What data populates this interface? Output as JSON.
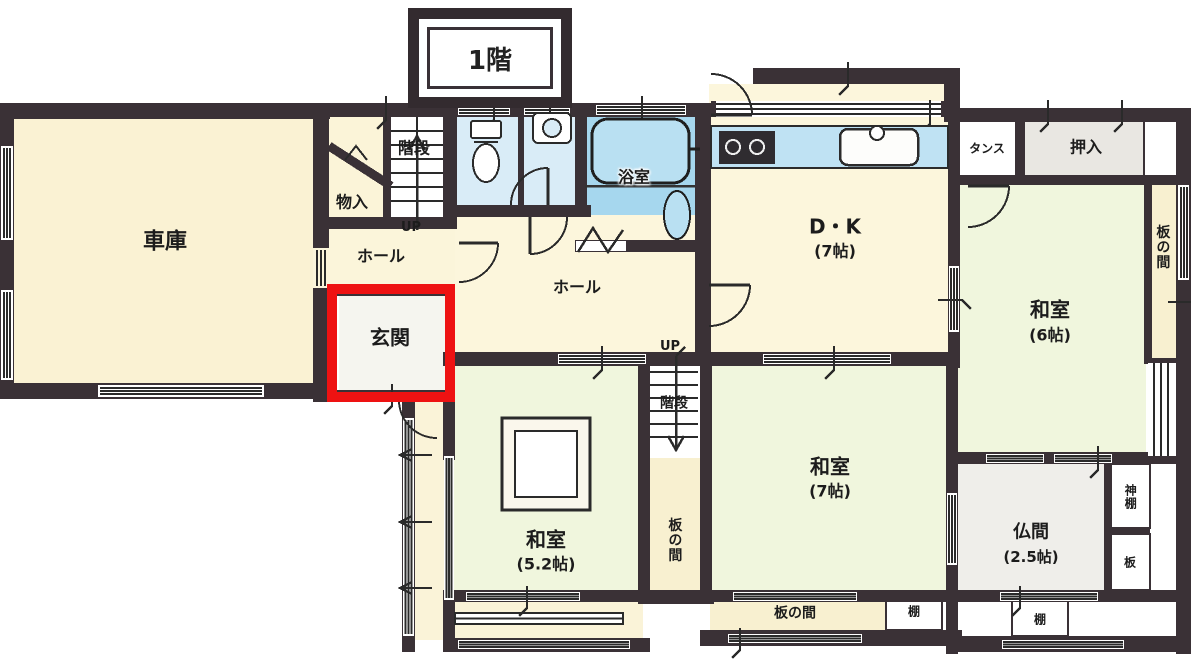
{
  "floor_title": "1階",
  "colors": {
    "wall": "#3a3136",
    "highlight_red": "#ee1212",
    "bath_blue": "#a6d7ee",
    "fixture_blue": "#d9ecf7",
    "counter_blue": "#bfe2f3",
    "tatami_green": "#f0f6dd",
    "cream": "#fbf4d8",
    "itanoma_tan": "#f8f0d0",
    "closet_gray": "#e9e7e2"
  },
  "rooms": {
    "garage": {
      "label": "車庫"
    },
    "storage": {
      "label": "物入"
    },
    "stairs_upper": {
      "label": "階段",
      "direction": "UP"
    },
    "hall_upper": {
      "label": "ホール"
    },
    "entrance": {
      "label": "玄関"
    },
    "bathroom": {
      "label": "浴室"
    },
    "hall_main": {
      "label": "ホール"
    },
    "dining_kitchen": {
      "label": "D・K",
      "size": "(7帖)"
    },
    "tansu": {
      "label": "タンス"
    },
    "oshiire": {
      "label": "押入"
    },
    "washitsu_6": {
      "label": "和室",
      "size": "(6帖)"
    },
    "itanoma_right": {
      "label": "板の間"
    },
    "washitsu_7": {
      "label": "和室",
      "size": "(7帖)"
    },
    "stairs_lower": {
      "label": "階段",
      "direction": "UP"
    },
    "itanoma_center": {
      "label": "板の間"
    },
    "washitsu_5_2": {
      "label": "和室",
      "size": "(5.2帖)"
    },
    "butsuma": {
      "label": "仏間",
      "size": "(2.5帖)"
    },
    "kamidana": {
      "label": "神棚"
    },
    "ita": {
      "label": "板"
    },
    "itanoma_bottom": {
      "label": "板の間"
    },
    "shelf_left": {
      "label": "棚"
    },
    "shelf_right": {
      "label": "棚"
    }
  }
}
